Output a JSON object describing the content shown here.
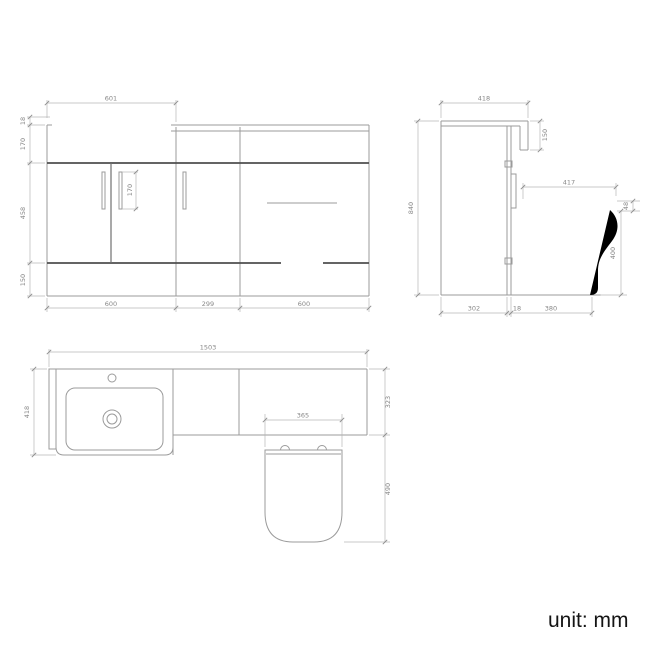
{
  "unit_label": "unit: mm",
  "front_view": {
    "basin_width": "601",
    "worktop_thickness": "18",
    "worktop_band_height": "170",
    "door_height": "458",
    "plinth_height": "150",
    "handle_height": "170",
    "vanity_unit_width": "600",
    "mid_unit_width": "299",
    "wc_unit_width": "600"
  },
  "side_view": {
    "overall_depth": "418",
    "worktop_return_height": "150",
    "overall_height": "840",
    "seat_depth": "417",
    "seat_thickness": "48",
    "seat_height": "400",
    "cabinet_depth": "302",
    "back_panel_thickness": "18",
    "pan_projection": "380"
  },
  "plan_view": {
    "overall_width": "1503",
    "basin_unit_depth": "418",
    "worktop_depth": "323",
    "seat_width": "365",
    "wc_projection": "490"
  }
}
